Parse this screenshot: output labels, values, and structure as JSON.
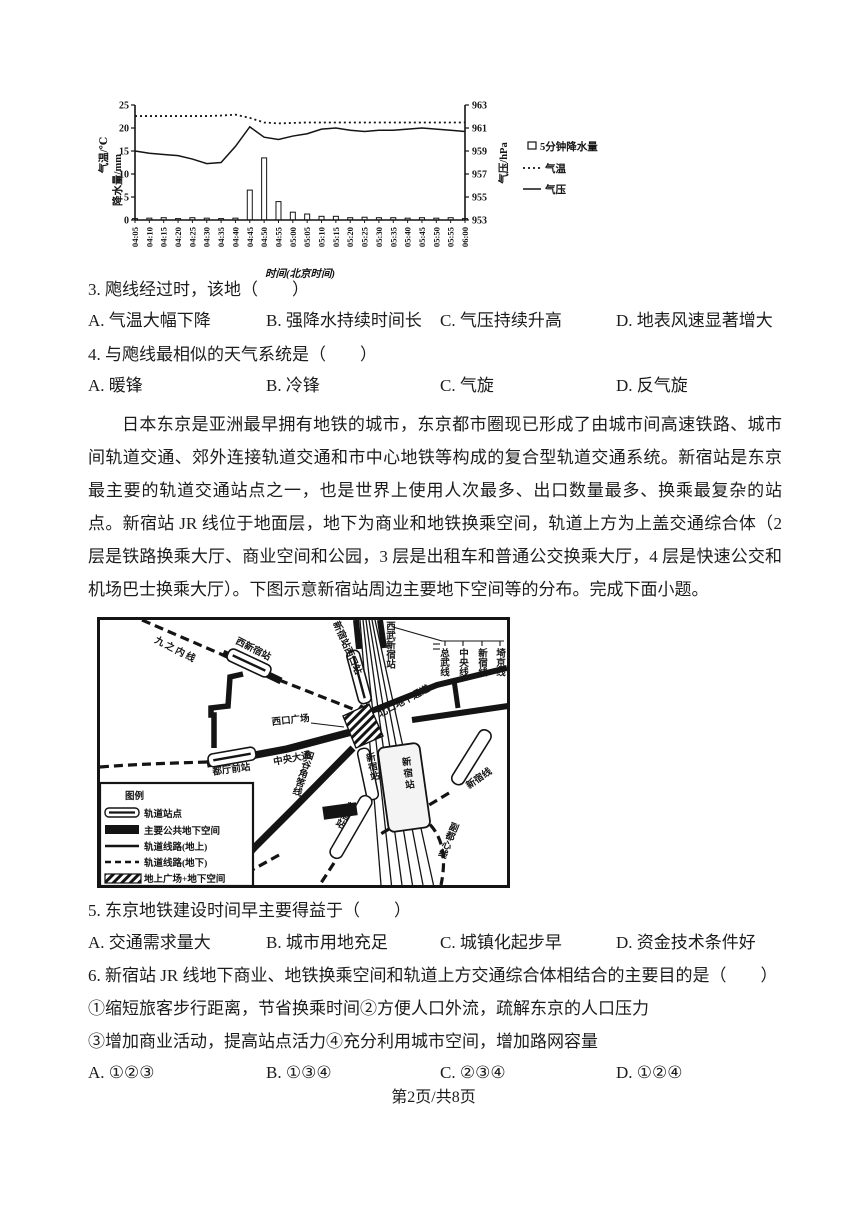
{
  "page": {
    "footer": "第2页/共8页"
  },
  "chart": {
    "y_left_label_1": "气温/℃",
    "y_left_label_2": "降水量/mm",
    "y_right_label": "气压/hPa",
    "x_label": "时间(北京时间)",
    "legend_bar": "5分钟降水量",
    "legend_temp": "气温",
    "legend_pressure": "气压"
  },
  "chart_data": {
    "type": "combo-bar-line",
    "x": [
      "04:05",
      "04:10",
      "04:15",
      "04:20",
      "04:25",
      "04:30",
      "04:35",
      "04:40",
      "04:45",
      "04:50",
      "04:55",
      "05:00",
      "05:05",
      "05:10",
      "05:15",
      "05:20",
      "05:25",
      "05:30",
      "05:35",
      "05:40",
      "05:45",
      "05:50",
      "05:55",
      "06:00"
    ],
    "left_ylim": [
      0,
      25
    ],
    "left_yticks": [
      0,
      5,
      10,
      15,
      20,
      25
    ],
    "right_ylim": [
      953,
      963
    ],
    "right_yticks": [
      953,
      955,
      957,
      959,
      961,
      963
    ],
    "series": [
      {
        "name": "5分钟降水量",
        "type": "bar",
        "axis": "left",
        "values": [
          0.3,
          0.4,
          0.5,
          0.3,
          0.5,
          0.4,
          0.3,
          0.4,
          6.5,
          13.5,
          4.0,
          1.7,
          1.3,
          0.8,
          0.8,
          0.5,
          0.6,
          0.5,
          0.5,
          0.4,
          0.5,
          0.4,
          0.5,
          0.3
        ]
      },
      {
        "name": "气温",
        "type": "line-dotted",
        "axis": "left",
        "values": [
          22.6,
          22.6,
          22.6,
          22.6,
          22.6,
          22.6,
          22.7,
          22.9,
          22.2,
          21.2,
          21.0,
          21.1,
          21.2,
          21.2,
          21.2,
          21.2,
          21.2,
          21.2,
          21.2,
          21.2,
          21.2,
          21.2,
          21.2,
          21.2
        ]
      },
      {
        "name": "气压",
        "type": "line",
        "axis": "right",
        "values": [
          959.0,
          958.8,
          958.7,
          958.6,
          958.3,
          957.9,
          958.0,
          959.4,
          961.1,
          960.2,
          960.0,
          960.3,
          960.5,
          960.9,
          961.0,
          960.8,
          960.7,
          960.8,
          960.8,
          960.9,
          961.0,
          960.9,
          960.8,
          960.7
        ]
      }
    ],
    "title": "",
    "xlabel": "时间(北京时间)",
    "grid": false,
    "legend_position": "right"
  },
  "q3": {
    "text": "3. 飑线经过时，该地（　　）",
    "options": [
      "A. 气温大幅下降",
      "B. 强降水持续时间长",
      "C. 气压持续升高",
      "D. 地表风速显著增大"
    ]
  },
  "q4": {
    "text": "4. 与飑线最相似的天气系统是（　　）",
    "options": [
      "A. 暖锋",
      "B. 冷锋",
      "C. 气旋",
      "D. 反气旋"
    ]
  },
  "passage": "日本东京是亚洲最早拥有地铁的城市，东京都市圈现已形成了由城市间高速铁路、城市间轨道交通、郊外连接轨道交通和市中心地铁等构成的复合型轨道交通系统。新宿站是东京最主要的轨道交通站点之一，也是世界上使用人次最多、出口数量最多、换乘最复杂的站点。新宿站 JR 线位于地面层，地下为商业和地铁换乘空间，轨道上方为上盖交通综合体（2 层是铁路换乘大厅、商业空间和公园，3 层是出租车和普通公交换乘大厅，4 层是快速公交和机场巴士换乘大厅）。下图示意新宿站周边主要地下空间等的分布。完成下面小题。",
  "map": {
    "lines": {
      "marunouchi": "九之内线",
      "sobu": "总武线",
      "chuo": "中央线",
      "shinjuku_jr": "新宿线",
      "saikyo": "埼京线",
      "yotsuya": "四谷角筈线",
      "shinjuku_right": "新宿线",
      "fukutoshin": "副都心线"
    },
    "stations": {
      "nishi_shinjuku": "西新宿站",
      "seibu_shinjuku": "西武新宿站",
      "shinjuku_west_exit": "新宿站西口站",
      "tochomae": "都厅前站",
      "shinjuku_main": "新宿站",
      "shinjuku_narrow": "新宿站",
      "shinjuku_diag": "新宿站",
      "shinjuku_small": "新宿站"
    },
    "places": {
      "west_plaza": "西口广场",
      "north_passage": "北口地下通道",
      "chuo_avenue": "中央大通"
    },
    "legend": {
      "title": "图例",
      "items": [
        "轨道站点",
        "主要公共地下空间",
        "轨道线路(地上)",
        "轨道线路(地下)",
        "地上广场+地下空间"
      ]
    }
  },
  "q5": {
    "text": "5. 东京地铁建设时间早主要得益于（　　）",
    "options": [
      "A. 交通需求量大",
      "B. 城市用地充足",
      "C. 城镇化起步早",
      "D. 资金技术条件好"
    ]
  },
  "q6": {
    "text": "6. 新宿站 JR 线地下商业、地铁换乘空间和轨道上方交通综合体相结合的主要目的是（　　）",
    "sub1": "①缩短旅客步行距离，节省换乘时间②方便人口外流，疏解东京的人口压力",
    "sub2": "③增加商业活动，提高站点活力④充分利用城市空间，增加路网容量",
    "options": [
      "A. ①②③",
      "B. ①③④",
      "C. ②③④",
      "D. ①②④"
    ]
  }
}
